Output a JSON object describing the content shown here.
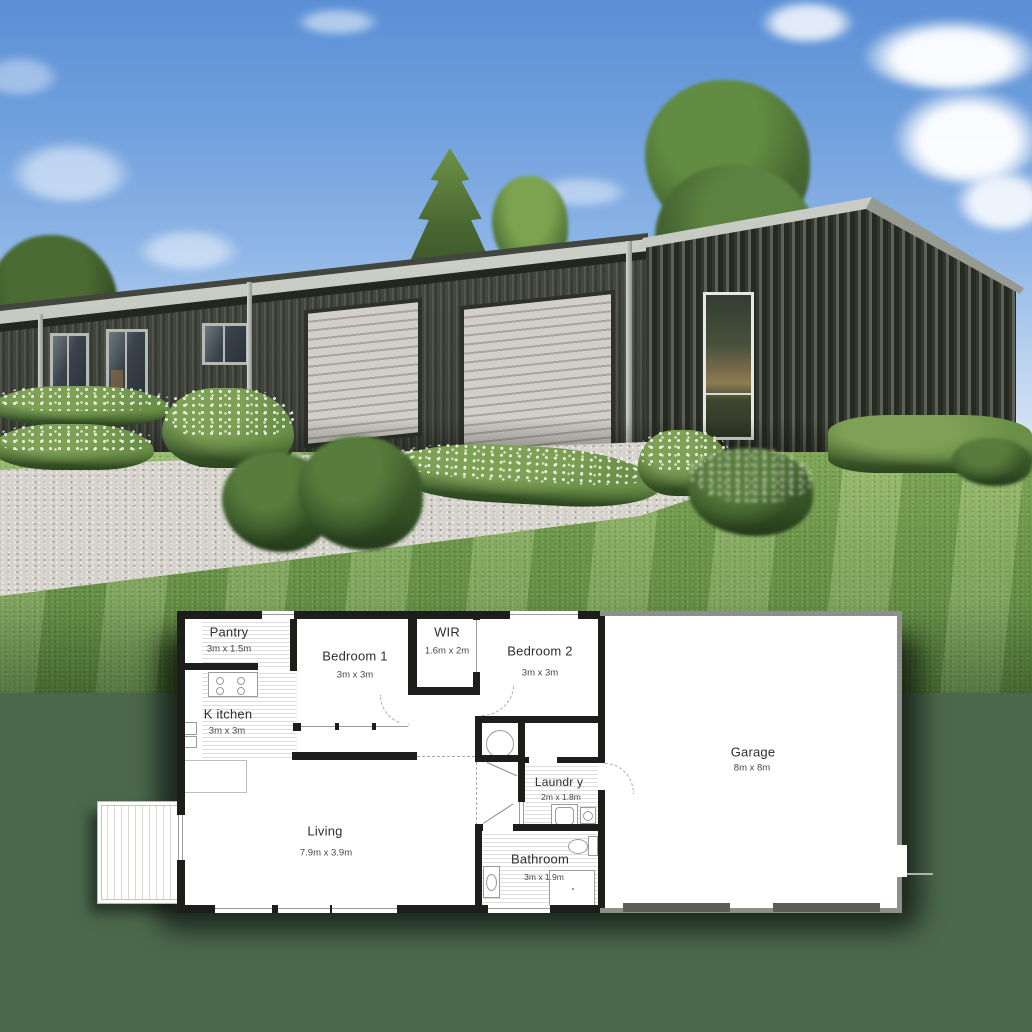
{
  "scene": {
    "description": "Architectural render of a dark corrugated barn-style home with double roller doors above an overlaid black-and-white floor plan",
    "colors": {
      "sky_top": "#5a8fd5",
      "sky_horizon": "#eef4f9",
      "cladding_dark": "#3c4038",
      "roof_flashing": "#dee1da",
      "roller_door": "#d1cfc8",
      "lawn_green": "#76a050",
      "backdrop_green": "#4b684d",
      "plan_wall": "#1d1d1b",
      "garage_wall": "#8d8f89"
    }
  },
  "floorplan": {
    "rooms": [
      {
        "id": "pantry",
        "name": "Pantry",
        "dims": "3m x 1.5m"
      },
      {
        "id": "bedroom1",
        "name": "Bedroom 1",
        "dims": "3m x 3m"
      },
      {
        "id": "wir",
        "name": "WIR",
        "dims": "1.6m x 2m"
      },
      {
        "id": "bedroom2",
        "name": "Bedroom 2",
        "dims": "3m x 3m"
      },
      {
        "id": "kitchen",
        "name": "K itchen",
        "dims": "3m x 3m"
      },
      {
        "id": "garage",
        "name": "Garage",
        "dims": "8m x 8m"
      },
      {
        "id": "laundry",
        "name": "Laundr y",
        "dims": "2m x 1.8m"
      },
      {
        "id": "living",
        "name": "Living",
        "dims": "7.9m x 3.9m"
      },
      {
        "id": "bathroom",
        "name": "Bathroom",
        "dims": "3m x 1.9m"
      }
    ]
  }
}
